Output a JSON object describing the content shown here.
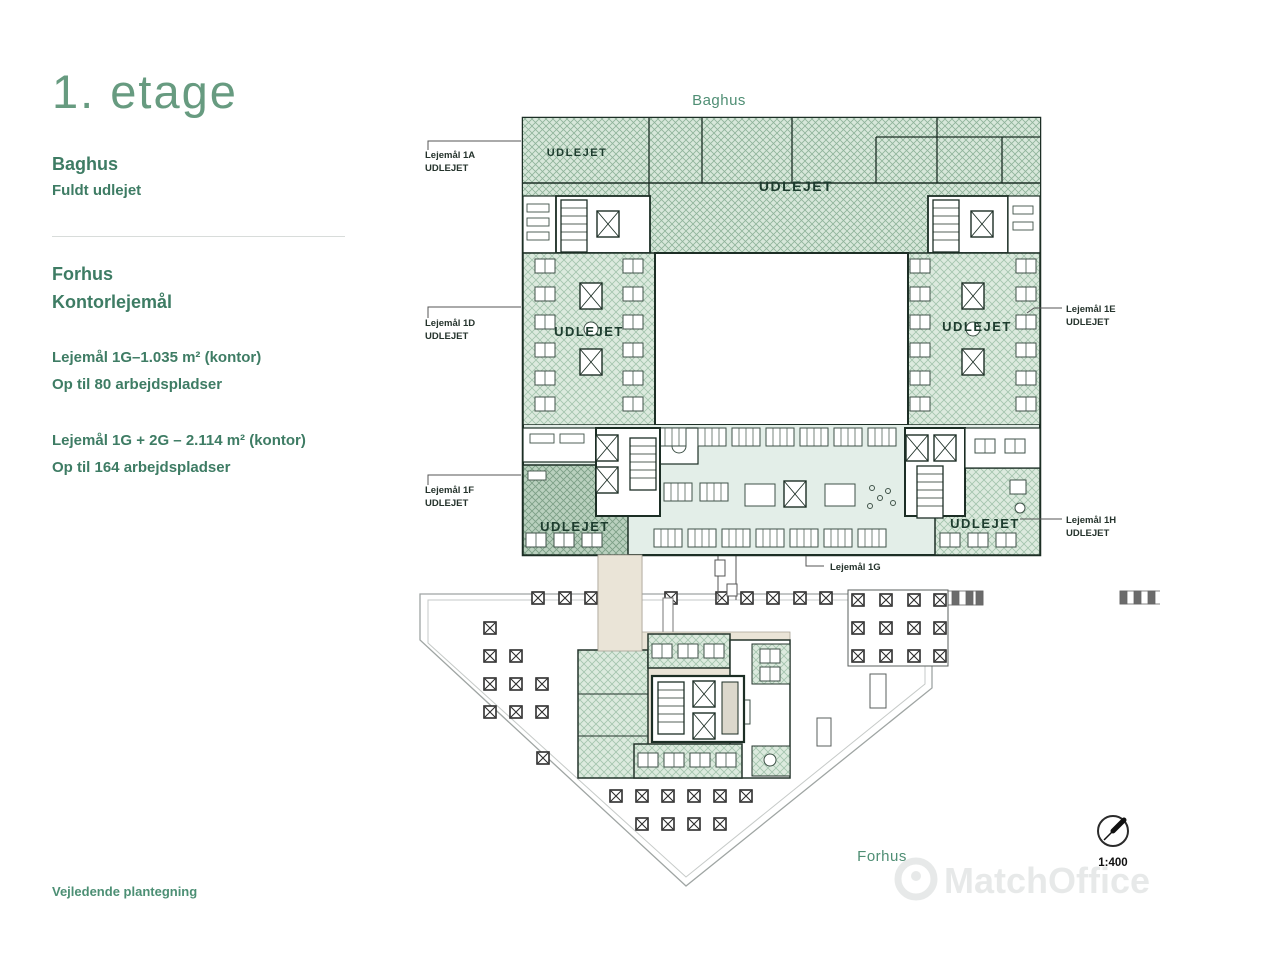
{
  "sidebar": {
    "title": "1. etage",
    "baghus": {
      "title": "Baghus",
      "status": "Fuldt udlejet"
    },
    "forhus": {
      "title": "Forhus",
      "subtitle": "Kontorlejemål"
    },
    "units": [
      {
        "line1": "Lejemål 1G–1.035 m² (kontor)",
        "line2": "Op til 80 arbejdspladser"
      },
      {
        "line1": "Lejemål 1G + 2G – 2.114 m² (kontor)",
        "line2": "Op til 164 arbejdspladser"
      }
    ],
    "footnote": "Vejledende plantegning"
  },
  "plan": {
    "baghus_label": "Baghus",
    "forhus_label": "Forhus",
    "scale_label": "1:400",
    "watermark": "MatchOffice",
    "udlejet": "UDLEJET",
    "callouts": [
      {
        "name": "Lejemål 1A",
        "status": "UDLEJET"
      },
      {
        "name": "Lejemål 1D",
        "status": "UDLEJET"
      },
      {
        "name": "Lejemål 1F",
        "status": "UDLEJET"
      },
      {
        "name": "Lejemål 1E",
        "status": "UDLEJET"
      },
      {
        "name": "Lejemål 1H",
        "status": "UDLEJET"
      },
      {
        "name": "Lejemål 1G",
        "status": ""
      }
    ],
    "colors": {
      "accent_green": "#4f8e74",
      "hatch_green": "#8fb39a",
      "text_green": "#3e7c64"
    }
  }
}
